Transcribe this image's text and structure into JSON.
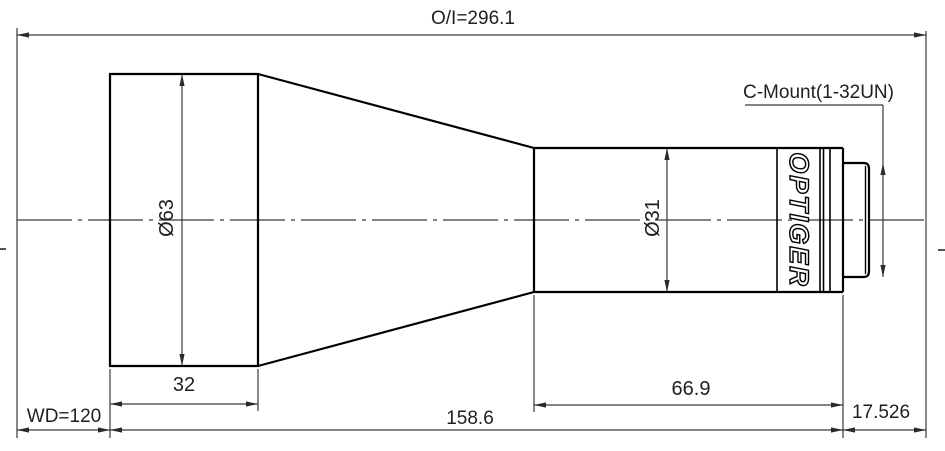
{
  "drawing": {
    "overall_dimension": "O/I=296.1",
    "mount_label": "C-Mount(1-32UN)",
    "brand": "OPTIGER",
    "front_diameter": "Ø63",
    "rear_diameter": "Ø31",
    "front_length": "32",
    "working_distance": "WD=120",
    "body_length": "158.6",
    "rear_length": "66.9",
    "flange_distance": "17.526",
    "colors": {
      "outline": "#000000",
      "dimension_lines": "#3a3a3a",
      "text": "#1d1f24",
      "background": "#ffffff"
    }
  }
}
